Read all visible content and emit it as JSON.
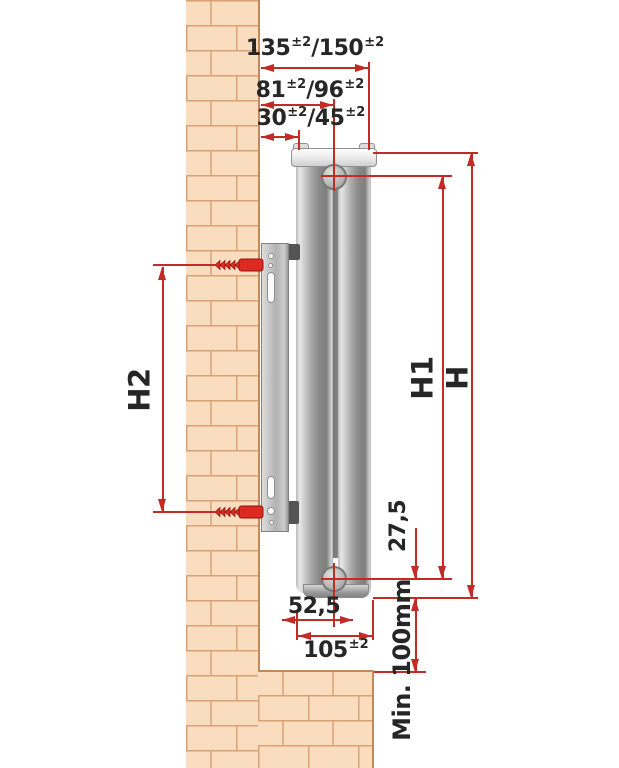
{
  "dims": {
    "sep": "/",
    "total_depth": {
      "v1": "135",
      "t1": "±2",
      "v2": "150",
      "t2": "±2"
    },
    "pipe_depth": {
      "v1": "81",
      "t1": "±2",
      "v2": "96",
      "t2": "±2"
    },
    "bracket_depth": {
      "v1": "30",
      "t1": "±2",
      "v2": "45",
      "t2": "±2"
    },
    "height_overall": "H",
    "height_pipe_centers": "H1",
    "height_bracket": "H2",
    "pipe_bottom_offset": "27,5",
    "pipe_from_back": "52,5",
    "bottom_depth": {
      "v": "105",
      "t": "±2"
    },
    "min_floor_clearance": "Min. 100mm"
  },
  "colors": {
    "dimension_red": "#c22b26",
    "screw_red": "#dd2b22",
    "brick_fill": "#f9ddbe",
    "brick_line": "#d8a176",
    "text": "#262626"
  }
}
